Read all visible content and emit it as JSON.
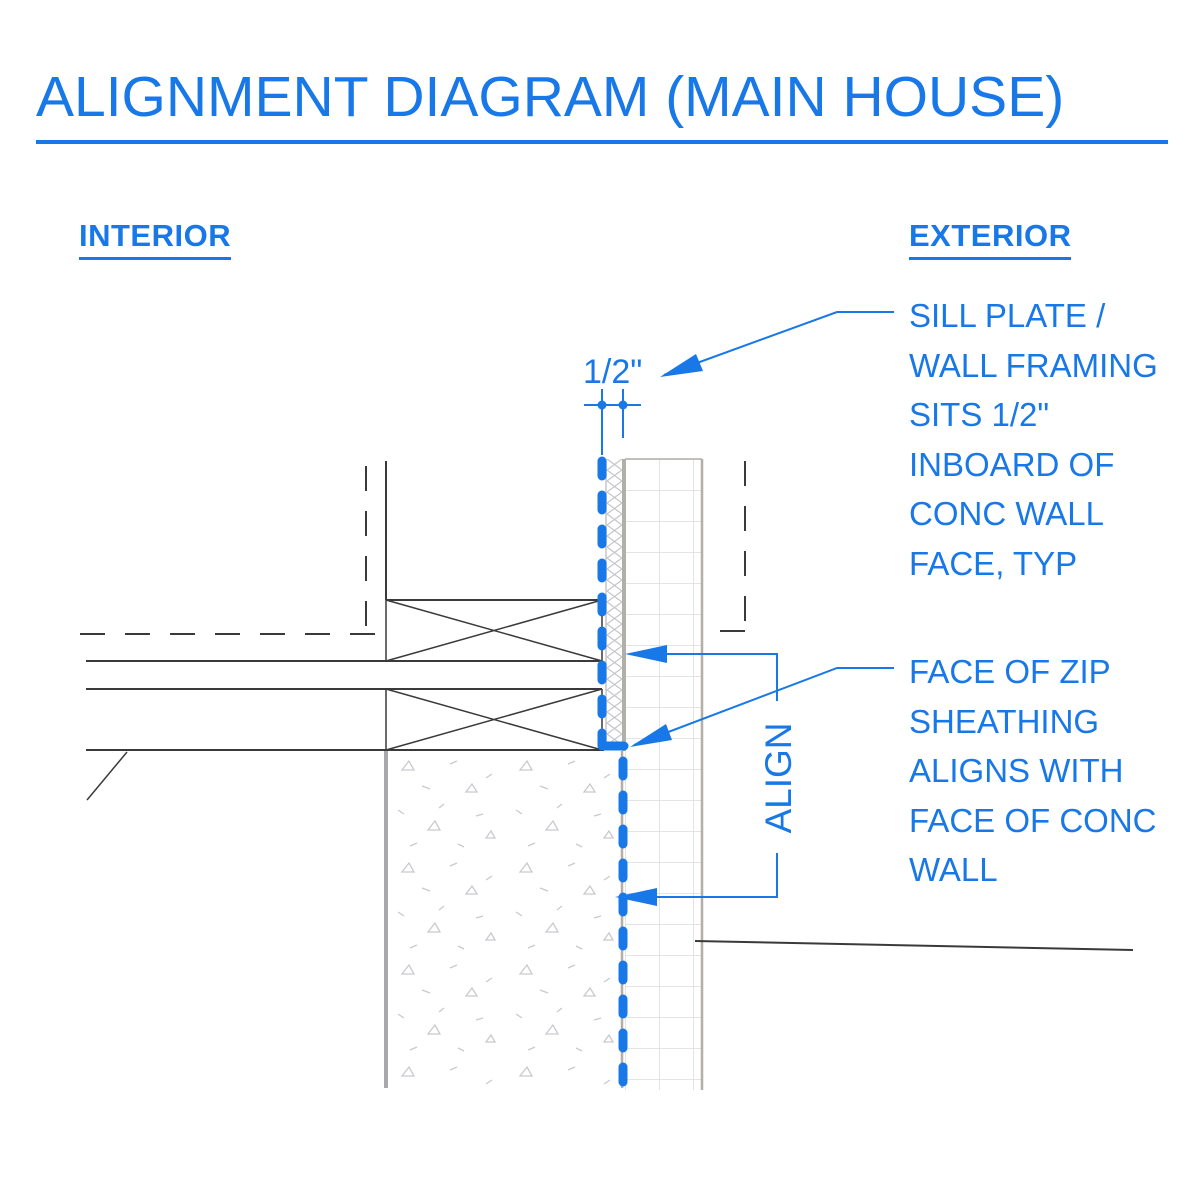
{
  "header": {
    "title": "ALIGNMENT DIAGRAM (MAIN HOUSE)"
  },
  "labels": {
    "interior": "INTERIOR",
    "exterior": "EXTERIOR"
  },
  "dimension": {
    "value": "1/2\""
  },
  "callouts": {
    "align_label": "ALIGN",
    "sill_plate_note": {
      "lines": [
        "SILL PLATE /",
        "WALL FRAMING",
        "SITS 1/2\"",
        "INBOARD OF",
        "CONC WALL",
        "FACE, TYP"
      ]
    },
    "zip_note": {
      "lines": [
        "FACE OF ZIP",
        "SHEATHING",
        "ALIGNS WITH",
        "FACE OF CONC",
        "WALL"
      ]
    }
  },
  "theme": {
    "accent_blue": "#1878E8",
    "line_black": "#3a3a3a",
    "concrete_gray": "#a9a9ad",
    "grid_gray": "#dcdcde"
  }
}
